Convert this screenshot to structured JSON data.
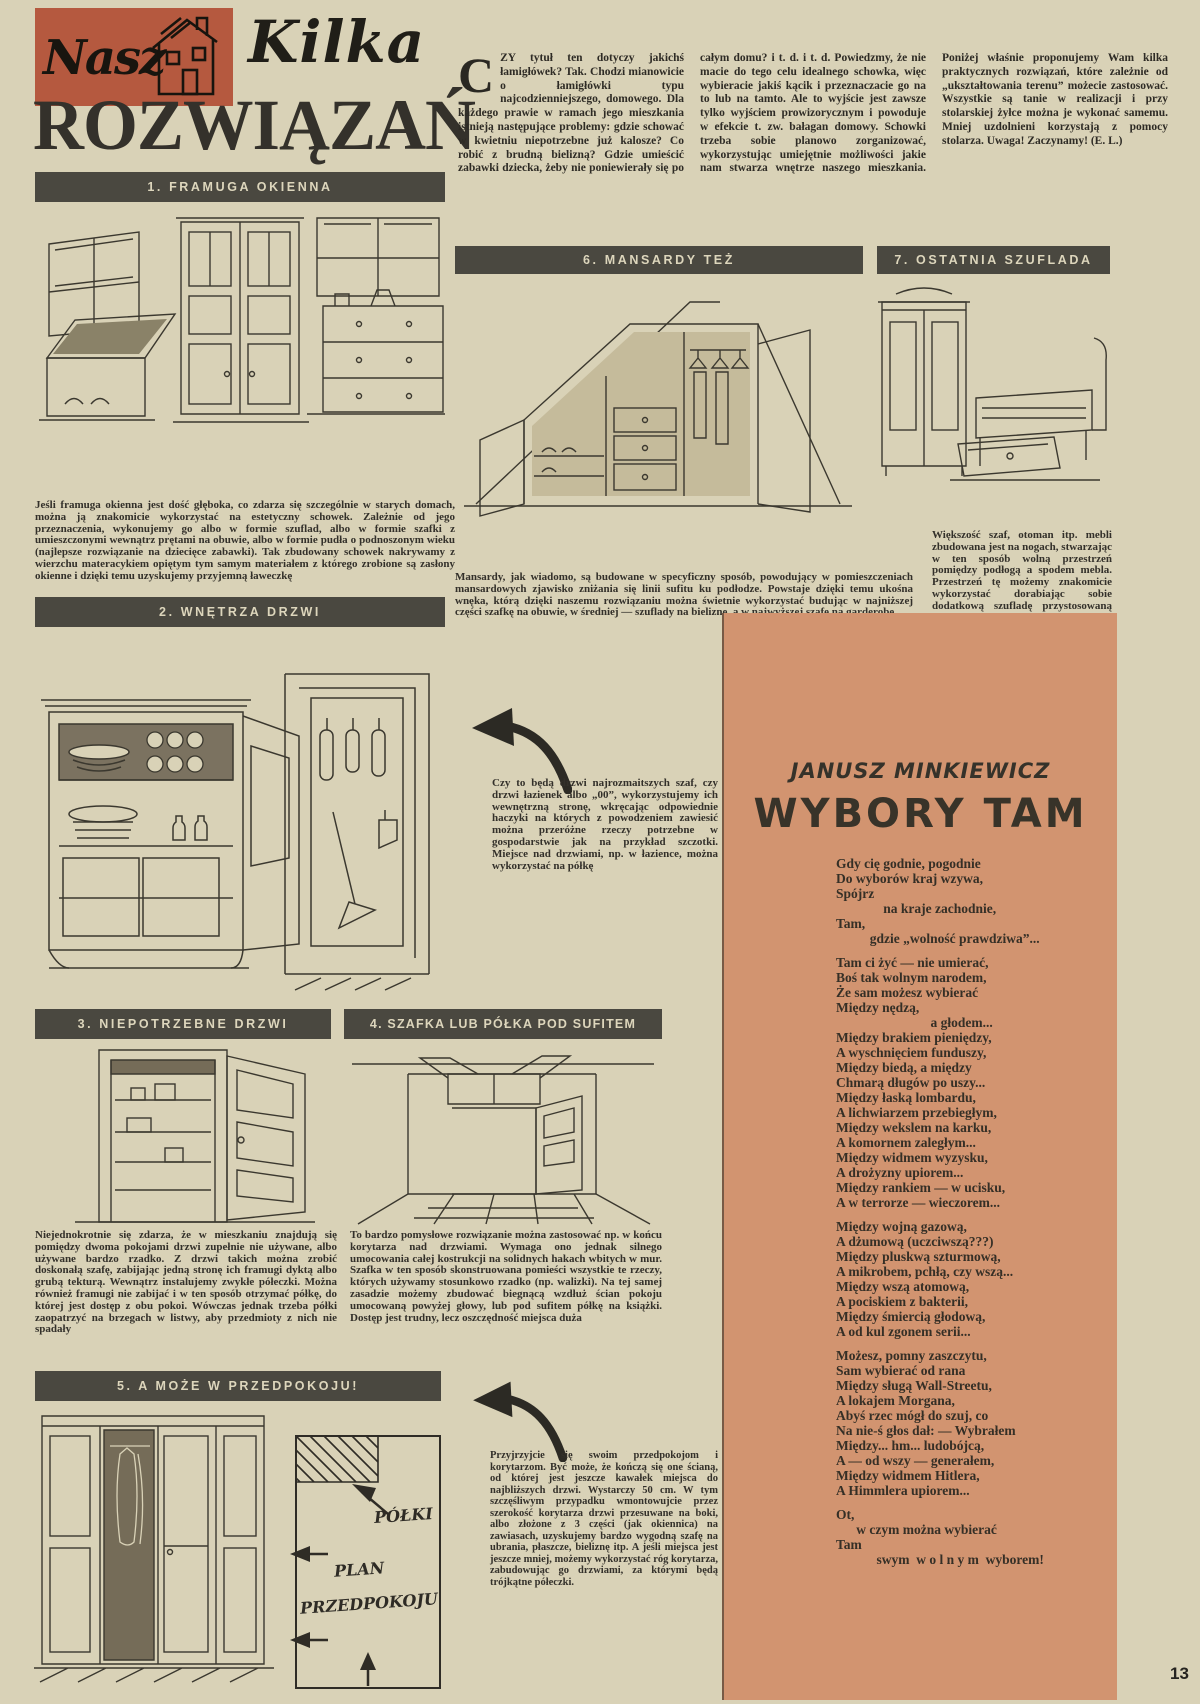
{
  "page": {
    "number": "13"
  },
  "colors": {
    "paper": "#d9d2b7",
    "ink": "#2c2a25",
    "bar_bg": "#4a4840",
    "bar_text": "#ddd6bc",
    "logo_bg": "#b5593f",
    "poem_bg": "#d29470"
  },
  "masthead": {
    "logo_word": "Nasz",
    "title_script": "Kilka",
    "title_main": "ROZWIĄZAŃ"
  },
  "intro": {
    "drop_cap": "C",
    "text": "ZY tytuł ten dotyczy jakichś łamigłówek? Tak. Chodzi mianowicie o łamigłówki typu najcodzienniejszego, domowego. Dla każdego prawie w ramach jego mieszkania istnieją następujące problemy: gdzie schować w kwietniu niepotrzebne już kalosze? Co robić z brudną bielizną? Gdzie umieścić zabawki dziecka, żeby nie poniewierały się po całym domu? i t. d. i t. d. Powiedzmy, że nie macie do tego celu idealnego schowka, więc wybieracie jakiś kącik i przeznaczacie go na to lub na tamto. Ale to wyjście jest zawsze tylko wyjściem prowizorycznym i powoduje w efekcie t. zw. bałagan domowy. Schowki trzeba sobie planowo zorganizować, wykorzystując umiejętnie możliwości jakie nam stwarza wnętrze naszego mieszkania. Poniżej właśnie proponujemy Wam kilka praktycznych rozwiązań, które zależnie od „ukształtowania terenu” możecie zastosować. Wszystkie są tanie w realizacji i przy stolarskiej żyłce można je wykonać samemu. Mniej uzdolnieni korzystają z pomocy stolarza. Uwaga! Zaczynamy!",
    "byline": "(E. L.)"
  },
  "sections": {
    "s1": {
      "bar": "1. FRAMUGA OKIENNA",
      "caption": "Jeśli framuga okienna jest dość głęboka, co zdarza się szczególnie w starych domach, można ją znakomicie wykorzystać na estetyczny schowek. Zależnie od jego przeznaczenia, wykonujemy go albo w formie szuflad, albo w formie szafki z umieszczonymi wewnątrz prętami na obuwie, albo w formie pudła o podnoszonym wieku (najlepsze rozwiązanie na dziecięce zabawki). Tak zbudowany schowek nakrywamy z wierzchu materacykiem opiętym tym samym materiałem z którego zrobione są zasłony okienne i dzięki temu uzyskujemy przyjemną ławeczkę"
    },
    "s2": {
      "bar": "2. WNĘTRZA DRZWI",
      "caption": "Czy to będą drzwi najrozmaitszych szaf, czy drzwi łazienek albo „00”, wykorzystujemy ich wewnętrzną stronę, wkręcając odpowiednie haczyki na których z powodzeniem zawiesić można przeróżne rzeczy potrzebne w gospodarstwie jak na przykład szczotki. Miejsce nad drzwiami, np. w łazience, można wykorzystać na półkę"
    },
    "s3": {
      "bar": "3. NIEPOTRZEBNE DRZWI",
      "caption": "Niejednokrotnie się zdarza, że w mieszkaniu znajdują się pomiędzy dwoma pokojami drzwi zupełnie nie używane, albo używane bardzo rzadko. Z drzwi takich można zrobić doskonałą szafę, zabijając jedną stronę ich framugi dyktą albo grubą tekturą. Wewnątrz instalujemy zwykłe półeczki. Można również framugi nie zabijać i w ten sposób otrzymać półkę, do której jest dostęp z obu pokoi. Wówczas jednak trzeba półki zaopatrzyć na brzegach w listwy, aby przedmioty z nich nie spadały"
    },
    "s4": {
      "bar": "4. SZAFKA LUB PÓŁKA POD SUFITEM",
      "caption": "To bardzo pomysłowe rozwiązanie można zastosować np. w końcu korytarza nad drzwiami. Wymaga ono jednak silnego umocowania całej kostrukcji na solidnych hakach wbitych w mur. Szafka w ten sposób skonstruowana pomieści wszystkie te rzeczy, których używamy stosunkowo rzadko (np. walizki). Na tej samej zasadzie możemy zbudować biegnącą wzdłuż ścian pokoju umocowaną powyżej głowy, lub pod sufitem półkę na książki. Dostęp jest trudny, lecz oszczędność miejsca duża"
    },
    "s5": {
      "bar": "5. A MOŻE W PRZEDPOKOJU!",
      "caption": "Przyjrzyjcie się swoim przedpokojom i korytarzom. Być może, że kończą się one ścianą, od której jest jeszcze kawałek miejsca do najbliższych drzwi. Wystarczy 50 cm. W tym szczęśliwym przypadku wmontowujcie przez szerokość korytarza drzwi przesuwane na boki, albo złożone z 3 części (jak okiennica) na zawiasach, uzyskujemy bardzo wygodną szafę na ubrania, płaszcze, bieliznę itp. A jeśli miejsca jest jeszcze mniej, możemy wykorzystać róg korytarza, zabudowując go drzwiami, za którymi będą trójkątne półeczki."
    },
    "s6": {
      "bar": "6. MANSARDY TEŻ",
      "caption": "Mansardy, jak wiadomo, są budowane w specyficzny sposób, powodujący w pomieszczeniach mansardowych zjawisko zniżania się linii sufitu ku podłodze. Powstaje dzięki temu ukośna wnęka, którą dzięki naszemu rozwiązaniu można świetnie wykorzystać budując w najniższej części szafkę na obuwie, w średniej — szuflady na bieliznę, a w najwyższej szafę na garderobę"
    },
    "s7": {
      "bar": "7. OSTATNIA SZUFLADA",
      "caption": "Większość szaf, otoman itp. mebli zbudowana jest na nogach, stwarzając w ten sposób wolną przestrzeń pomiędzy podłogą a spodem mebla. Przestrzeń tę możemy znakomicie wykorzystać dorabiając sobie dodatkową szufladę przystosowaną wymiarami do wymiarów mebla"
    }
  },
  "plan": {
    "label_shelves": "PÓŁKI",
    "label_line1": "PLAN",
    "label_line2": "PRZEDPOKOJU"
  },
  "poem": {
    "author": "JANUSZ MINKIEWICZ",
    "title": "WYBORY TAM",
    "stanzas": [
      "Gdy cię godnie, pogodnie\nDo wyborów kraj wzywa,\nSpójrz\n              na kraje zachodnie,\nTam,\n          gdzie „wolność prawdziwa”...",
      "Tam ci żyć — nie umierać,\nBoś tak wolnym narodem,\nŻe sam możesz wybierać\nMiędzy nędzą,\n                            a głodem...\nMiędzy brakiem pieniędzy,\nA wyschnięciem funduszy,\nMiędzy biedą, a między\nChmarą długów po uszy...\nMiędzy łaską lombardu,\nA lichwiarzem przebiegłym,\nMiędzy wekslem na karku,\nA komornem zaległym...\nMiędzy widmem wyzysku,\nA drożyzny upiorem...\nMiędzy rankiem — w ucisku,\nA w terrorze — wieczorem...",
      "Między wojną gazową,\nA dżumową (uczciwszą???)\nMiędzy pluskwą szturmową,\nA mikrobem, pchłą, czy wszą...\nMiędzy wszą atomową,\nA pociskiem z bakterii,\nMiędzy śmiercią głodową,\nA od kul zgonem serii...",
      "Możesz, pomny zaszczytu,\nSam wybierać od rana\nMiędzy sługą Wall-Streetu,\nA lokajem Morgana,\nAbyś rzec mógł do szuj, co\nNa nie-ś głos dał: — Wybrałem\nMiędzy... hm... ludobójcą,\nA — od wszy — generałem,\nMiędzy widmem Hitlera,\nA Himmlera upiorem...",
      "Ot,\n      w czym można wybierać\nTam\n            swym  w o l n y m  wyborem!"
    ]
  }
}
